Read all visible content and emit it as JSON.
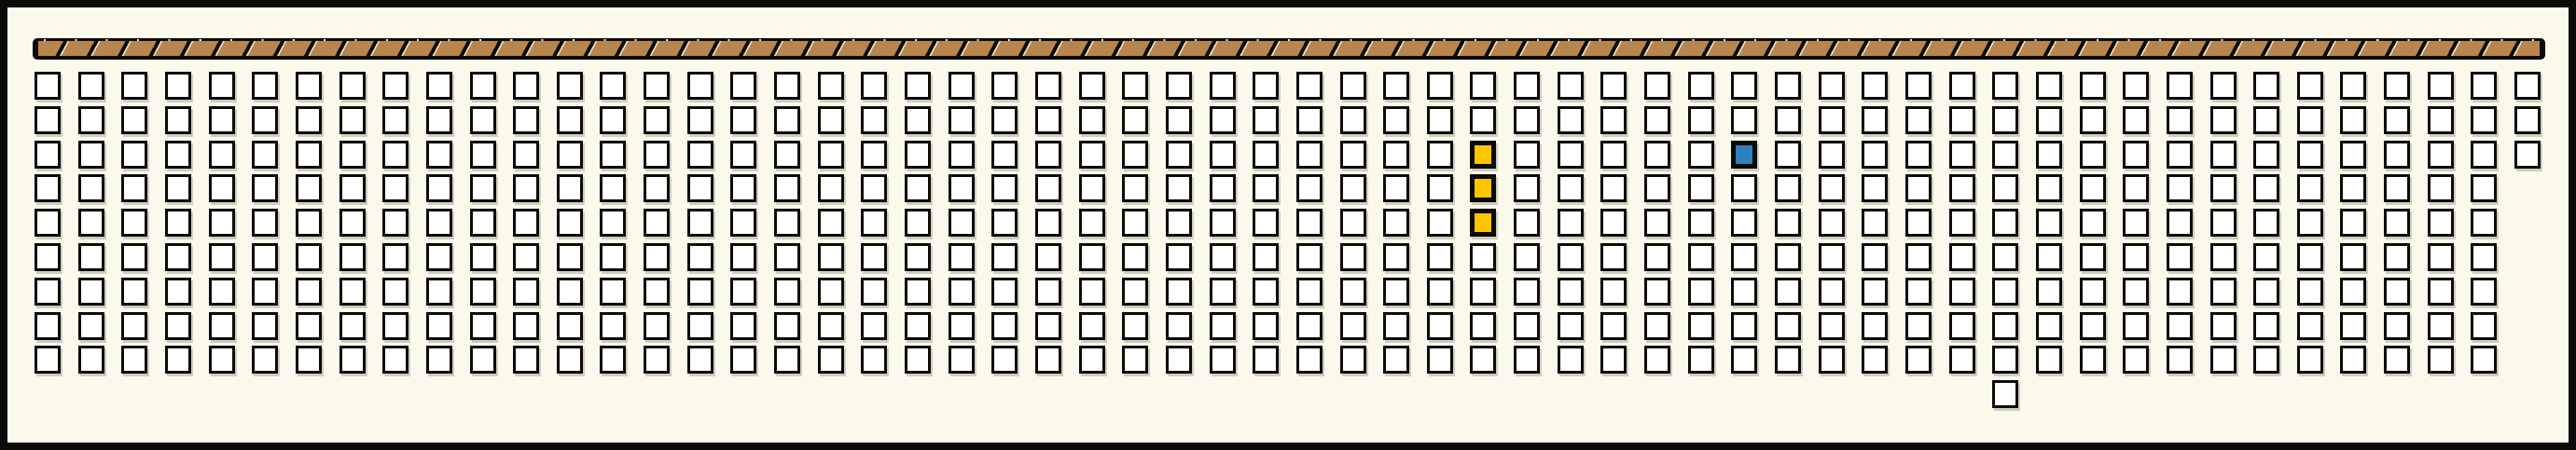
{
  "panel": {
    "background_color": "#FBF9EB",
    "frame_color": "#0B0B08"
  },
  "top_band": {
    "base_color": "#0C0C06",
    "hatch_color": "#B8854E",
    "highlight_color": "#EFE3C8",
    "tick_color": "#FFFFFF"
  },
  "seat_map": {
    "columns": 58,
    "standard_rows": 9,
    "seat_fill_color": "#FFFFFF",
    "seat_border_color": "#0B0B08",
    "highlight_colors": {
      "gold": "#FDC500",
      "blue": "#2F80C0"
    },
    "highlighted_cells": [
      {
        "col": 34,
        "row": 3,
        "color_id": "gold"
      },
      {
        "col": 34,
        "row": 4,
        "color_id": "gold"
      },
      {
        "col": 34,
        "row": 5,
        "color_id": "gold"
      },
      {
        "col": 40,
        "row": 3,
        "color_id": "blue"
      }
    ],
    "extra_cells": [
      {
        "col": 46,
        "row": 10
      }
    ],
    "short_columns": [
      {
        "col": 58,
        "visible_rows": 3
      }
    ]
  }
}
